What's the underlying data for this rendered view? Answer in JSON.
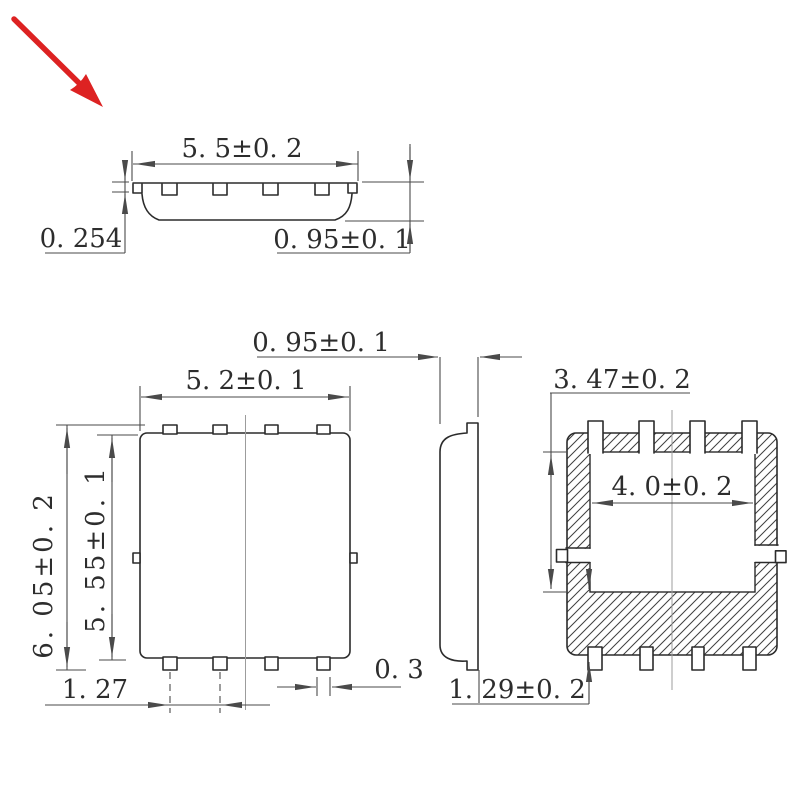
{
  "colors": {
    "background": "#ffffff",
    "outline": "#2b2b2b",
    "dimension_line": "#4a4a4a",
    "center_line": "#9c9c9c",
    "hatch": "#3f3f3f",
    "text": "#2d2d2d",
    "pointer_red": "#dd2222"
  },
  "views": {
    "top_profile": {
      "dims": {
        "body_width": "5. 5±0. 2",
        "lead_thickness": "0. 254",
        "body_height": "0. 95±0. 1"
      }
    },
    "front": {
      "dims": {
        "body_width": "5. 2±0. 1",
        "overall_height": "6. 05±0. 2",
        "body_height": "5. 55±0. 1",
        "lead_pitch": "1. 27",
        "lead_width": "0. 3"
      }
    },
    "side": {
      "dims": {
        "body_thickness": "0. 95±0. 1"
      }
    },
    "section": {
      "dims": {
        "cavity_depth": "3. 47±0. 2",
        "cavity_width": "4. 0±0. 2",
        "base_height": "1. 29±0. 2"
      }
    }
  }
}
